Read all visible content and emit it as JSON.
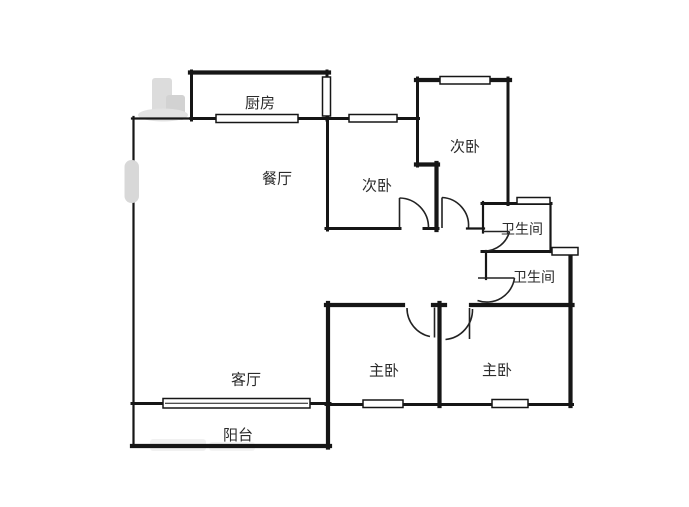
{
  "figure": {
    "type": "floor-plan",
    "background_color": "#ffffff",
    "wall_color": "#161616",
    "label_color": "#2b2b2b",
    "watermark_color": "#d9d9d9"
  },
  "rooms": [
    {
      "id": "kitchen",
      "label": "厨房"
    },
    {
      "id": "dining-room",
      "label": "餐厅"
    },
    {
      "id": "bedroom-2-left",
      "label": "次卧"
    },
    {
      "id": "bedroom-2-right",
      "label": "次卧"
    },
    {
      "id": "bathroom-upper",
      "label": "卫生间"
    },
    {
      "id": "bathroom-lower",
      "label": "卫生间"
    },
    {
      "id": "master-left",
      "label": "主卧"
    },
    {
      "id": "master-right",
      "label": "主卧"
    },
    {
      "id": "living-room",
      "label": "客厅"
    },
    {
      "id": "balcony",
      "label": "阳台"
    }
  ],
  "counts": {
    "bedrooms": 4,
    "bathrooms": 2,
    "living_areas": 2,
    "balconies": 1,
    "kitchens": 1
  }
}
